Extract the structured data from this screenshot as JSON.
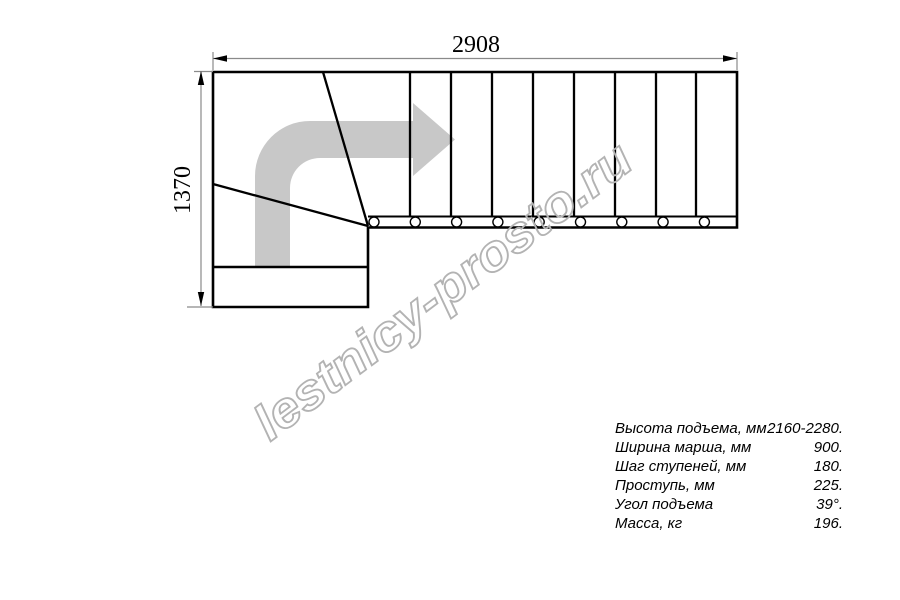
{
  "drawing": {
    "title": "L-shaped staircase plan with winder steps",
    "dimension_top": "2908",
    "dimension_left": "1370",
    "straight_steps": 9,
    "baluster_count": 9
  },
  "colors": {
    "line": "#000000",
    "dimension_line": "#8a8a8a",
    "direction_arrow": "#c8c8c8",
    "watermark_outline": "#b3b3b3"
  },
  "watermark": {
    "text": "lestnicy-prosto.ru"
  },
  "specs": {
    "rows": [
      {
        "label": "Высота подъема, мм",
        "value": "2160-2280."
      },
      {
        "label": "Ширина марша, мм",
        "value": "900."
      },
      {
        "label": "Шаг ступеней, мм",
        "value": "180."
      },
      {
        "label": "Проступь, мм",
        "value": "225."
      },
      {
        "label": "Угол подъема",
        "value": "39°."
      },
      {
        "label": "Масса, кг",
        "value": "196."
      }
    ]
  }
}
